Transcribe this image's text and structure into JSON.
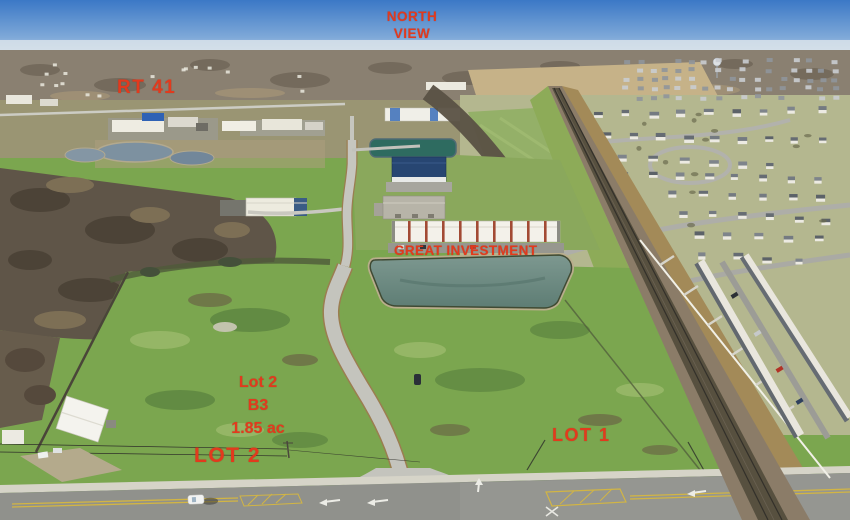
{
  "annotations": {
    "north_view": {
      "line1": "NORTH",
      "line2": "VIEW"
    },
    "route": "RT 41",
    "investment": "GREAT INVESTMENT",
    "lot2_detail": {
      "name": "Lot 2",
      "zoning": "B3",
      "acreage": "1.85 ac"
    },
    "lot2": "LOT 2",
    "lot1": "LOT 1"
  },
  "colors": {
    "annotation_red": "#e23a1d",
    "sky_blue": "#3b78c6",
    "grass_green": "#7ba64f",
    "pond_teal": "#6f8f86"
  }
}
